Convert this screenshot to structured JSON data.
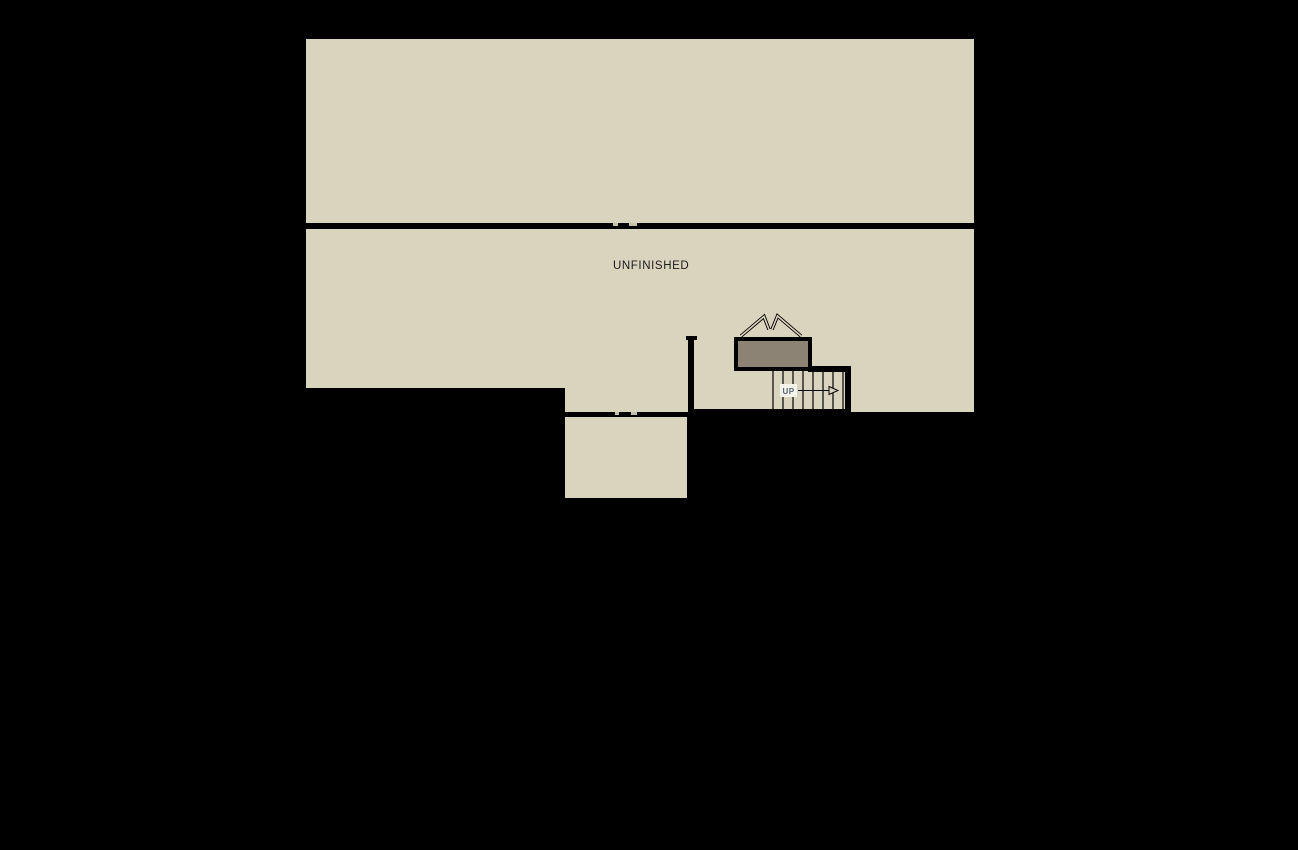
{
  "floor_plan": {
    "labels": {
      "unfinished_room": "UNFINISHED",
      "stair_direction": "UP"
    },
    "colors": {
      "background": "#000000",
      "floor": "#d9d4bd",
      "wall": "#000000",
      "landing": "#8c8374",
      "up_text": "#5c6675",
      "up_bg": "#f4f3ec",
      "notch": "#c6c1ab",
      "room_label_text": "#1a1a1a"
    }
  }
}
